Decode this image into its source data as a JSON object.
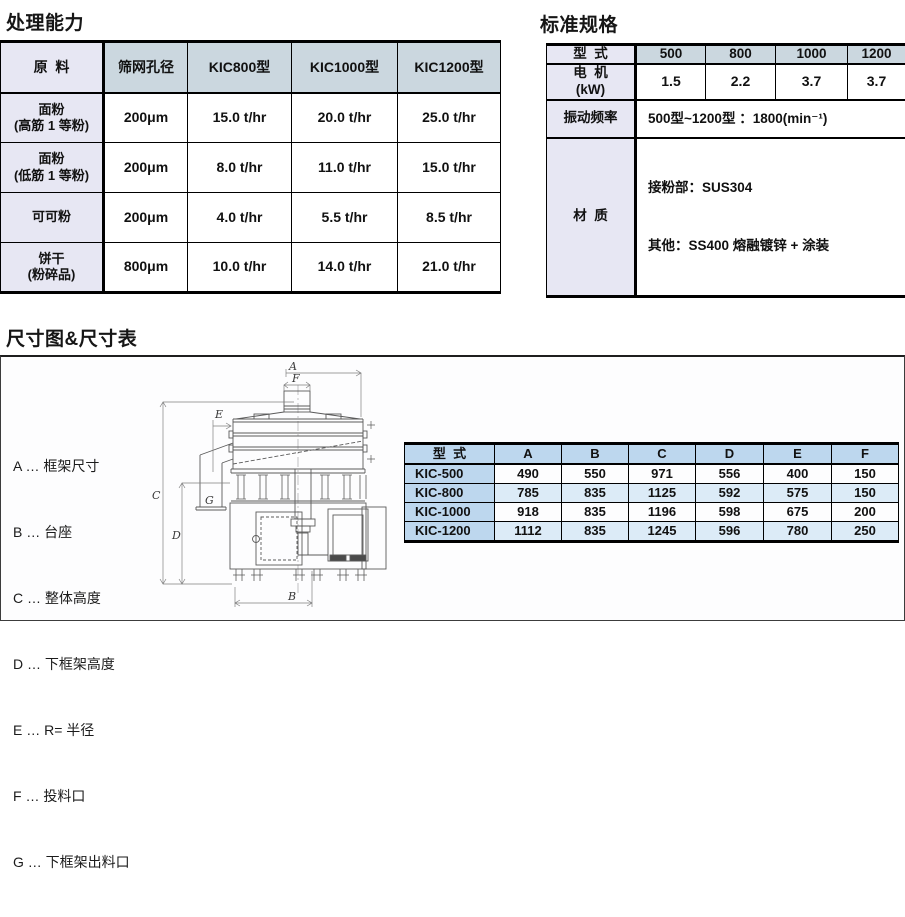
{
  "capacity": {
    "title": "处理能力",
    "headers": [
      "原  料",
      "筛网孔径",
      "KIC800型",
      "KIC1000型",
      "KIC1200型"
    ],
    "rows": [
      {
        "material": "面粉\n(高筋 1 等粉)",
        "cells": [
          "200μm",
          "15.0 t/hr",
          "20.0 t/hr",
          "25.0 t/hr"
        ]
      },
      {
        "material": "面粉\n(低筋 1 等粉)",
        "cells": [
          "200μm",
          "8.0 t/hr",
          "11.0 t/hr",
          "15.0 t/hr"
        ]
      },
      {
        "material": "可可粉",
        "cells": [
          "200μm",
          "4.0 t/hr",
          "5.5 t/hr",
          "8.5 t/hr"
        ]
      },
      {
        "material": "饼干\n(粉碎品)",
        "cells": [
          "800μm",
          "10.0 t/hr",
          "14.0 t/hr",
          "21.0 t/hr"
        ]
      }
    ]
  },
  "specs": {
    "title": "标准规格",
    "model_label": "型  式",
    "models": [
      "500",
      "800",
      "1000",
      "1200"
    ],
    "motor": {
      "label": "电  机\n(kW)",
      "values": [
        "1.5",
        "2.2",
        "3.7",
        "3.7"
      ]
    },
    "vibration": {
      "label": "振动频率",
      "value": "500型~1200型 ：1800(min⁻¹)"
    },
    "material": {
      "label": "材  质",
      "lines": [
        "接粉部：SUS304",
        "其他：SS400 熔融镀锌 + 涂装"
      ]
    }
  },
  "dimensions": {
    "title": "尺寸图&尺寸表",
    "legend": [
      "A … 框架尺寸",
      "B … 台座",
      "C … 整体高度",
      "D … 下框架高度",
      "E … R= 半径",
      "F … 投料口",
      "G … 下框架出料口"
    ],
    "diagram_labels": {
      "a": "A",
      "b": "B",
      "c": "C",
      "d": "D",
      "e": "E",
      "f": "F",
      "g": "G"
    },
    "table": {
      "model_label": "型  式",
      "headers": [
        "A",
        "B",
        "C",
        "D",
        "E",
        "F"
      ],
      "rows": [
        {
          "model": "KIC-500",
          "values": [
            "490",
            "550",
            "971",
            "556",
            "400",
            "150"
          ]
        },
        {
          "model": "KIC-800",
          "values": [
            "785",
            "835",
            "1125",
            "592",
            "575",
            "150"
          ]
        },
        {
          "model": "KIC-1000",
          "values": [
            "918",
            "835",
            "1196",
            "598",
            "675",
            "200"
          ]
        },
        {
          "model": "KIC-1200",
          "values": [
            "1112",
            "835",
            "1245",
            "596",
            "780",
            "250"
          ]
        }
      ]
    }
  },
  "colors": {
    "label_lavender": "#e7e7f3",
    "header_bluegray": "#cbd7df",
    "dim_header_blue": "#bdd7ee",
    "dim_row_alt": "#dcebf7"
  }
}
